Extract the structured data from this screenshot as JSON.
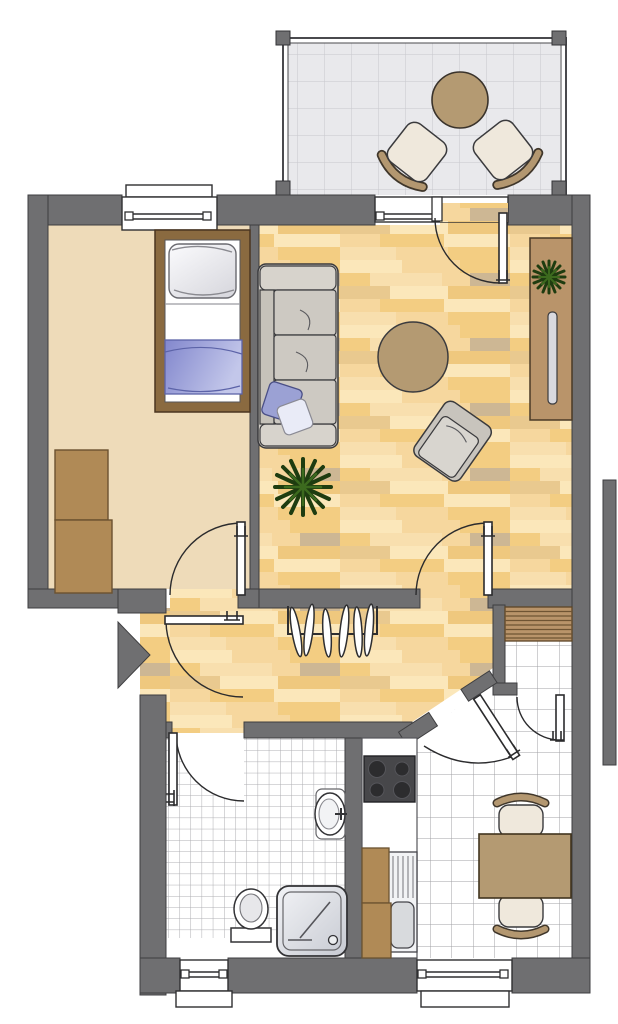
{
  "meta": {
    "type": "apartment-floor-plan",
    "canvas": {
      "width": 618,
      "height": 1024
    },
    "visible_text": []
  },
  "palette": {
    "wall": "#6f6f71",
    "wall_outline": "#3e3e40",
    "line": "#2b2b2d",
    "outside": "#ffffff",
    "bedroom_floor": "#eedbb9",
    "wood_base": "#f6d79e",
    "wood_light": "#fbe7ba",
    "wood_light2": "#f8dfae",
    "wood_mid": "#f3cd82",
    "wood_mid2": "#efc87e",
    "wood_tan": "#e9c98f",
    "wood_gray": "#cdb794",
    "balcony_floor": "#e9e9ec",
    "balcony_grid": "#c8c8cd",
    "tile_white": "#ffffff",
    "furniture_tan": "#b49a72",
    "cabinet_brown": "#b08a56",
    "shelf_brown": "#b9946a",
    "bed_frame": "#8a6a40",
    "blanket_blue": "#8287cd",
    "blanket_blue_light": "#c3c7ea",
    "pillow_white": "#f4f4f6",
    "sofa_gray": "#cfcbc4",
    "sofa_cushion": "#cdc9c2",
    "sofa_pillow_blue": "#9ba1d4",
    "chair_cream": "#efe8dc",
    "chair_back_tan": "#b39770",
    "plant_dark": "#1e3c10",
    "plant_mid": "#3c6a1e",
    "stove_dark": "#47474a",
    "burner_dark": "#2c2c2e",
    "white_fixture": "#ffffff"
  },
  "rooms": [
    {
      "id": "balcony",
      "floor": "grid-tiles",
      "furniture": [
        "round-table",
        "chair",
        "chair"
      ]
    },
    {
      "id": "bedroom",
      "floor": "plain-beige",
      "furniture": [
        "single-bed",
        "wardrobe"
      ]
    },
    {
      "id": "living-room",
      "floor": "wood-parquet",
      "furniture": [
        "sofa",
        "round-rug",
        "armchair",
        "sideboard",
        "tv",
        "floor-plant",
        "sideboard-plant"
      ]
    },
    {
      "id": "hallway",
      "floor": "wood-parquet",
      "furniture": [
        "coat-rack-with-hangers"
      ]
    },
    {
      "id": "bathroom",
      "floor": "small-white-tiles",
      "furniture": [
        "toilet",
        "shower",
        "washbasin"
      ]
    },
    {
      "id": "kitchen-dining",
      "floor": "large-white-tiles",
      "furniture": [
        "stove",
        "counter",
        "sink",
        "cabinets",
        "dining-table",
        "chair",
        "chair"
      ]
    },
    {
      "id": "storage-niche",
      "floor": "large-white-tiles",
      "furniture": [
        "shelves"
      ]
    }
  ],
  "doors": [
    {
      "id": "entrance-door",
      "marker": "entrance-triangle"
    },
    {
      "id": "bedroom-door"
    },
    {
      "id": "living-room-door"
    },
    {
      "id": "balcony-door"
    },
    {
      "id": "bathroom-door"
    },
    {
      "id": "kitchen-door"
    },
    {
      "id": "storage-door"
    }
  ],
  "windows": [
    {
      "id": "bedroom-window",
      "wall": "top"
    },
    {
      "id": "balcony-window",
      "wall": "top"
    },
    {
      "id": "bathroom-window",
      "wall": "bottom"
    },
    {
      "id": "kitchen-window",
      "wall": "bottom"
    }
  ],
  "counts": {
    "rooms": 7,
    "doors": 7,
    "windows": 4,
    "plants": 2,
    "chairs": 4
  }
}
